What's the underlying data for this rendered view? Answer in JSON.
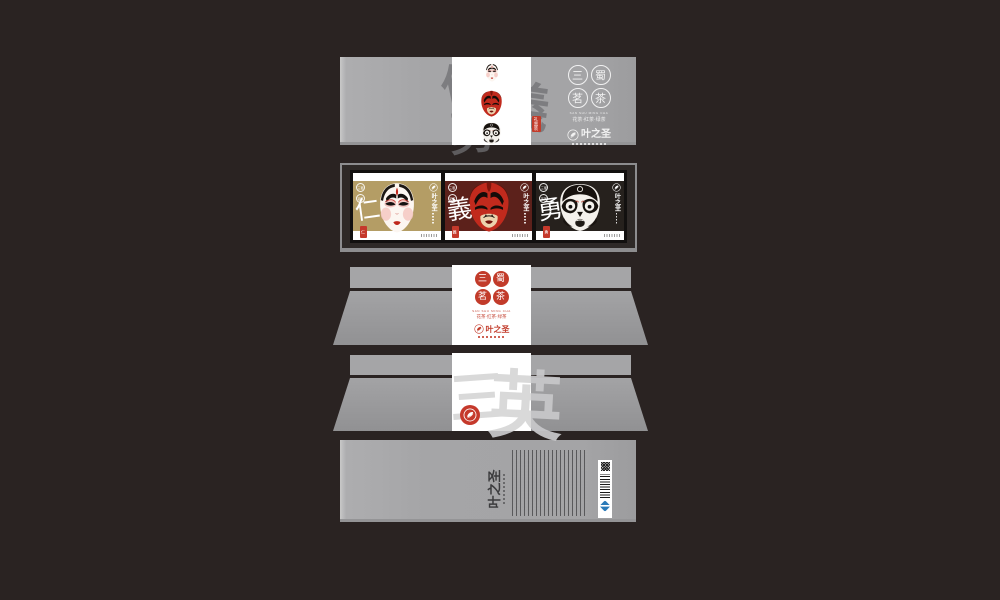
{
  "canvas": {
    "bg": "#2a2322",
    "panel_gray": "#a5a5a7",
    "accent_red": "#c23b2a"
  },
  "brand": {
    "name": "叶之圣"
  },
  "series": {
    "seals": [
      "三",
      "蜀",
      "茗",
      "茶"
    ],
    "name_en": "SAN SHU MING CHA",
    "teas": "花茶·红茶·绿茶"
  },
  "top_panel": {
    "watermark": [
      "仁",
      "義",
      "勇"
    ],
    "gift_seal": "礼盒装"
  },
  "display_panel": {
    "seal_pair": [
      "三蜀",
      "茗茶"
    ],
    "packages": [
      {
        "virtue": "仁",
        "bg": "#b49d65"
      },
      {
        "virtue": "義",
        "bg": "#5c211b"
      },
      {
        "virtue": "勇",
        "bg": "#26211d"
      }
    ]
  },
  "stamp_panel": {
    "watermark": [
      "三",
      "英"
    ]
  },
  "bottom_panel": {
    "brand": "叶之圣"
  }
}
